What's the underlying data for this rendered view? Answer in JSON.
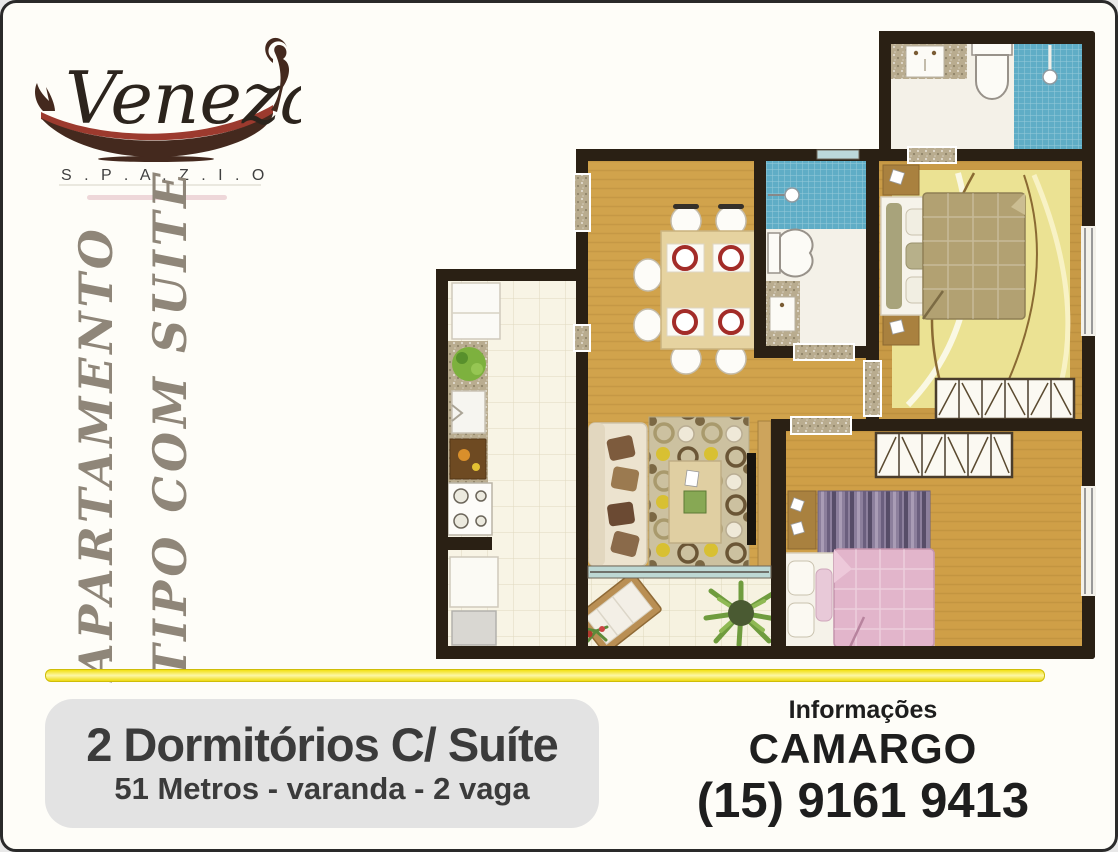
{
  "flyer": {
    "logo": {
      "brand": "Veneza",
      "subtitle": "S . P . A . Z . I . O"
    },
    "side_labels": {
      "line1": "APARTAMENTO",
      "line2": "TIPO COM SUITE"
    },
    "offer": {
      "title": "2 Dormitórios C/ Suíte",
      "details": "51 Metros - varanda - 2 vaga"
    },
    "contact": {
      "heading": "Informações",
      "name": "CAMARGO",
      "phone": "(15) 9161 9413"
    }
  },
  "colors": {
    "page-bg": "#fefdf8",
    "page-border": "#2a2a2a",
    "divider-yellow": "#f2e012",
    "offer-box-bg": "#e3e3e3",
    "offer-text": "#3b3b3b",
    "contact-text": "#1e1e1e",
    "side-label-text": "#8f8679",
    "gondola-brown": "#44291e",
    "gondola-stripe-red": "#9c3a2e"
  },
  "floorplan": {
    "rooms": [
      "suite-bathroom",
      "bathroom",
      "dining-room",
      "living-room",
      "kitchen",
      "service-area",
      "balcony",
      "hallway",
      "master-suite",
      "second-bedroom"
    ],
    "furniture": [
      "dining-table",
      "dining-chairs",
      "plates",
      "sofa",
      "circle-rug",
      "coffee-table",
      "tv",
      "double-bed",
      "wardrobes",
      "single-bed",
      "striped-rug",
      "fridge",
      "counter",
      "sink",
      "stove",
      "washer",
      "toilets",
      "showers",
      "lounge-chair",
      "plants"
    ],
    "colors": {
      "wall": "#2a2014",
      "wood-floor": "#d1a34c",
      "suite-floor": "#c89a46",
      "suite-rug": "#ebe293",
      "blue-tile": "#5fadc6",
      "bath-floor": "#f4f1e8",
      "kitchen-floor": "#f8f4e5",
      "granite": "#b9ac8f",
      "suite-blanket": "#b2a172",
      "pink-blanket": "#e2b5cb",
      "rug-base": "#ccc1a0",
      "striped-rug-purple": "#8c7f9c"
    }
  }
}
